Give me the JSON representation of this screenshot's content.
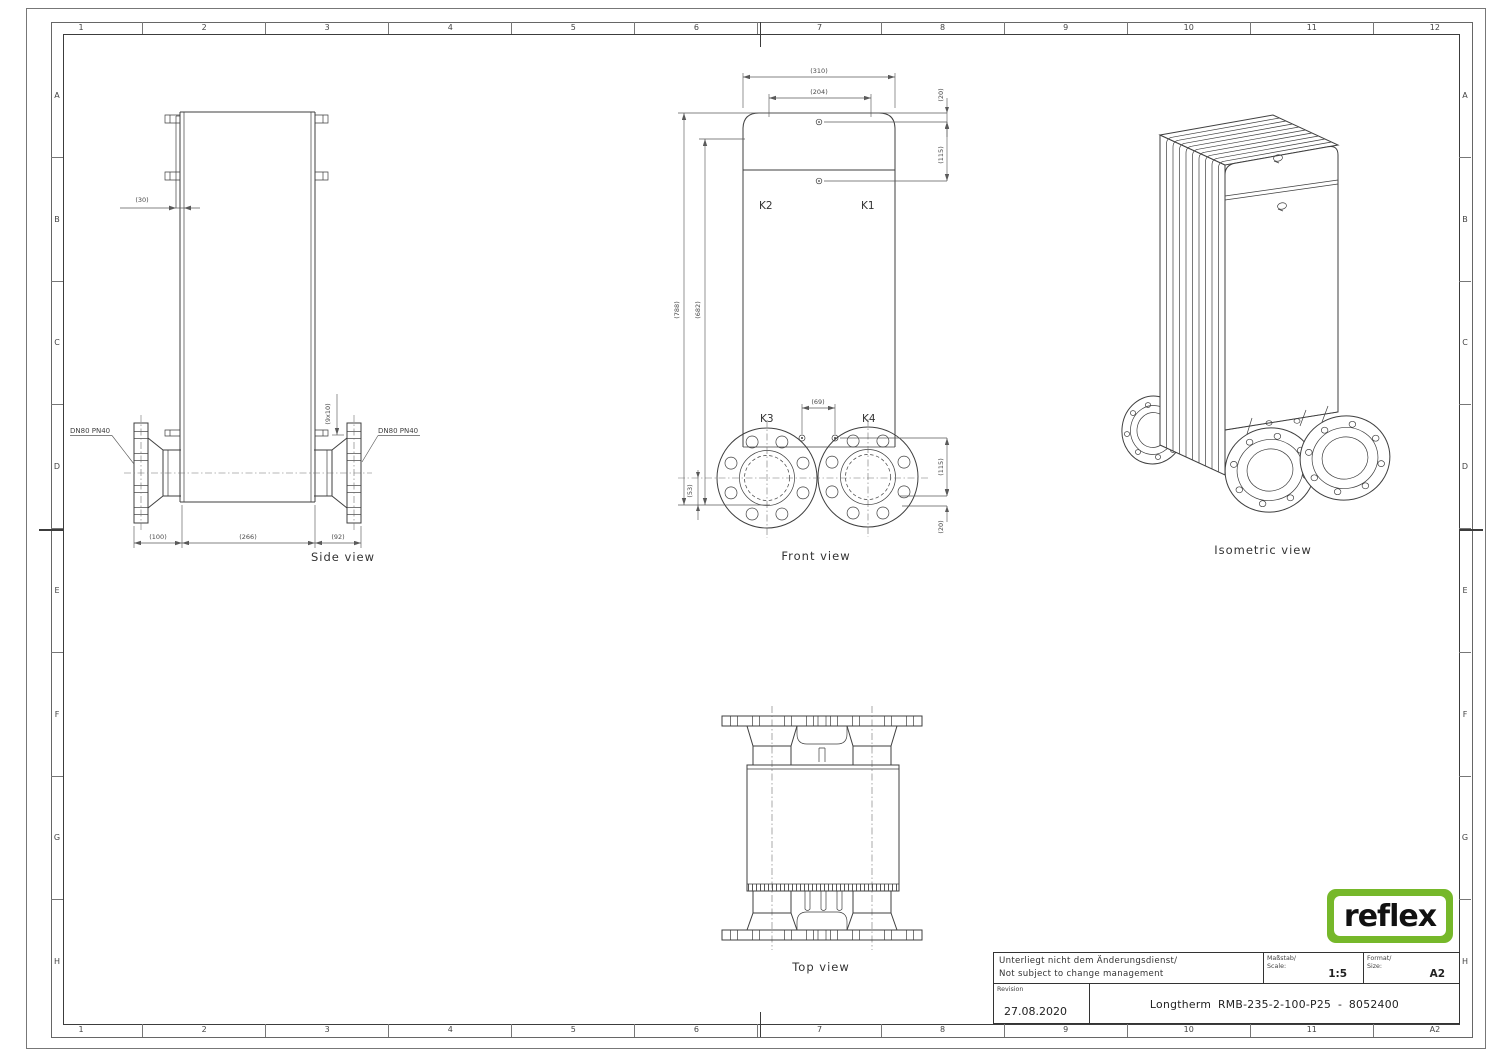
{
  "border": {
    "cols_top": [
      "1",
      "2",
      "3",
      "4",
      "5",
      "6",
      "7",
      "8",
      "9",
      "10",
      "11",
      "12"
    ],
    "cols_bottom": [
      "1",
      "2",
      "3",
      "4",
      "5",
      "6",
      "7",
      "8",
      "9",
      "10",
      "11",
      "A2"
    ],
    "rows": [
      "A",
      "B",
      "C",
      "D",
      "E",
      "F",
      "G",
      "H"
    ]
  },
  "views": {
    "side": {
      "label": "Side view",
      "flange_left": "DN80 PN40",
      "flange_right": "DN80 PN40",
      "dims": {
        "offset": "(30)",
        "pitch": "(9x10)",
        "d100": "(100)",
        "d266": "(266)",
        "d92": "(92)"
      }
    },
    "front": {
      "label": "Front view",
      "ports": {
        "k1": "K1",
        "k2": "K2",
        "k3": "K3",
        "k4": "K4"
      },
      "dims": {
        "w310": "(310)",
        "w204": "(204)",
        "t20": "(20)",
        "t115": "(115)",
        "h788": "(788)",
        "h682": "(682)",
        "b53": "(53)",
        "gap69": "(69)",
        "b115": "(115)",
        "b20": "(20)"
      }
    },
    "top": {
      "label": "Top view"
    },
    "iso": {
      "label": "Isometric view"
    }
  },
  "title_block": {
    "note_line1": "Unterliegt nicht dem Änderungsdienst/",
    "note_line2": "Not subject to change management",
    "scale_label1": "Maßstab/",
    "scale_label2": "Scale:",
    "scale_value": "1:5",
    "format_label1": "Format/",
    "format_label2": "Size:",
    "format_value": "A2",
    "revision_label": "Revision",
    "revision_date": "27.08.2020",
    "drawing_title": "Longtherm RMB-235-2-100-P25 - 8052400"
  },
  "logo": {
    "text": "reflex",
    "green": "#76b82a"
  }
}
